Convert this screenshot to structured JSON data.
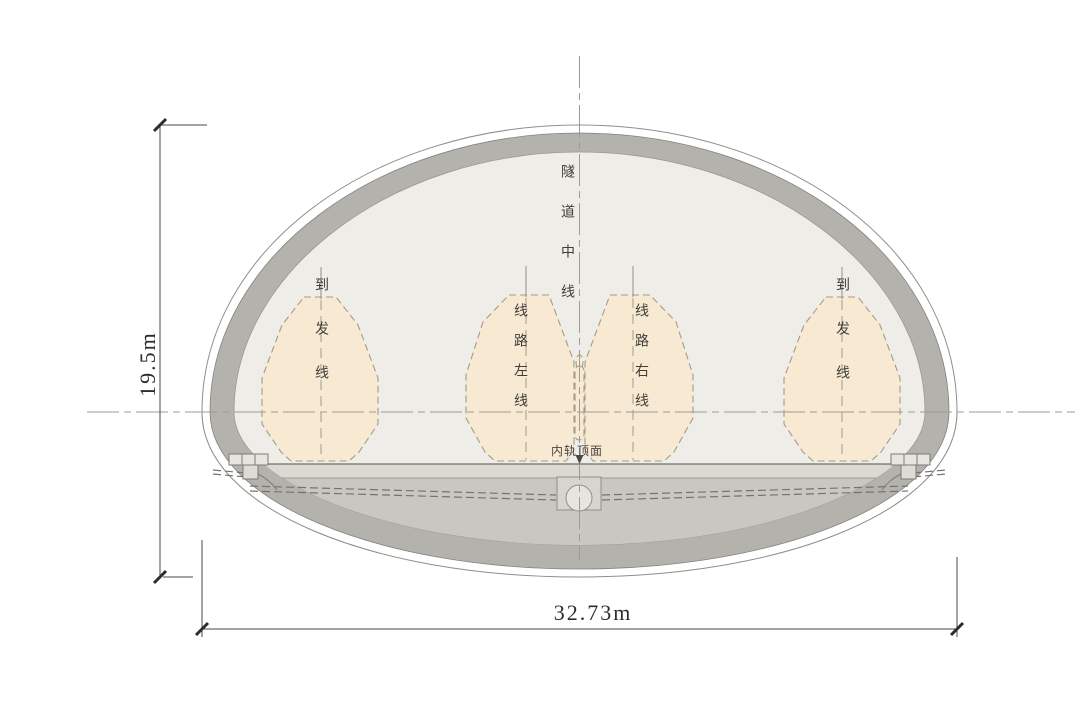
{
  "diagram": {
    "type": "tunnel-cross-section",
    "labels": {
      "tunnel_centerline": "隧道中线",
      "left_arrival_departure": "到发线",
      "route_left_line": "线路左线",
      "route_right_line": "线路右线",
      "right_arrival_departure": "到发线",
      "rail_top_surface": "内轨顶面"
    },
    "dimensions": {
      "height_label": "19.5m",
      "width_label": "32.73m"
    },
    "colors": {
      "lining_gray": "#b3b2ad",
      "interior_fill": "#efede8",
      "invert_fill": "#c9c7c1",
      "floor_slab": "#dcd9d2",
      "gauge_fill": "#f8e9d3",
      "gauge_outline": "#a69b87",
      "centerline_gray": "#9c9c97",
      "dimension_color": "#46443f",
      "outline_gray": "#8d8d89"
    }
  }
}
